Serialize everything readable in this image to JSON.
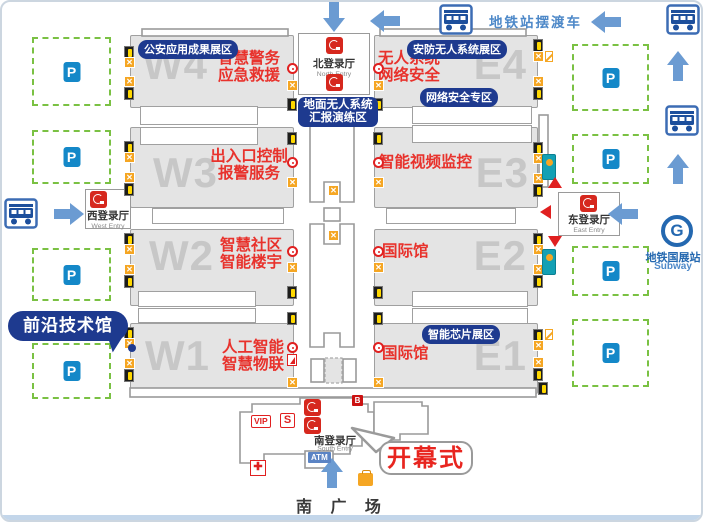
{
  "shuttle": {
    "label": "地铁站摆渡车"
  },
  "subway": {
    "zh": "地铁国展站",
    "en": "Subway",
    "glyph": "G"
  },
  "plaza": {
    "label": "南 广 场"
  },
  "callouts": {
    "frontier": "前沿技术馆",
    "opening": "开幕式"
  },
  "entries": {
    "north": {
      "zh": "北登录厅",
      "en": "North Entry"
    },
    "west": {
      "zh": "西登录厅",
      "en": "West Entry"
    },
    "east": {
      "zh": "东登录厅",
      "en": "East Entry"
    },
    "south": {
      "zh": "南登录厅",
      "en": "South Entry"
    }
  },
  "north_zone_badge": {
    "line1": "地面无人系统",
    "line2": "汇报演练区"
  },
  "halls": {
    "w4": {
      "code": "W4",
      "badge": "公安应用成果展区",
      "line1": "智慧警务",
      "line2": "应急救援"
    },
    "w3": {
      "code": "W3",
      "line1": "出入口控制",
      "line2": "报警服务"
    },
    "w2": {
      "code": "W2",
      "line1": "智慧社区",
      "line2": "智能楼宇"
    },
    "w1": {
      "code": "W1",
      "line1": "人工智能",
      "line2": "智慧物联"
    },
    "e4": {
      "code": "E4",
      "badge": "安防无人系统展区",
      "badge2": "网络安全专区",
      "line1": "无人系统",
      "line2": "网络安全"
    },
    "e3": {
      "code": "E3",
      "line1": "智能视频监控"
    },
    "e2": {
      "code": "E2",
      "line1": "国际馆"
    },
    "e1": {
      "code": "E1",
      "badge": "智能芯片展区",
      "line1": "国际馆"
    }
  },
  "badges": {
    "vip": "VIP",
    "s": "S",
    "b": "B",
    "atm": "ATM",
    "parking": "P",
    "cross": "✚"
  },
  "map": {
    "colors": {
      "arrow": "#6b9bd2",
      "bus": "#1d4f9c",
      "bus_border": "#3c6cb4",
      "red": "#e8322c",
      "navy": "#1e3a8f"
    },
    "parking": [
      {
        "x": 30,
        "y": 35,
        "w": 75,
        "h": 65
      },
      {
        "x": 30,
        "y": 128,
        "w": 75,
        "h": 50
      },
      {
        "x": 30,
        "y": 246,
        "w": 75,
        "h": 49
      },
      {
        "x": 30,
        "y": 341,
        "w": 75,
        "h": 52
      },
      {
        "x": 570,
        "y": 42,
        "w": 73,
        "h": 63
      },
      {
        "x": 570,
        "y": 132,
        "w": 73,
        "h": 46
      },
      {
        "x": 570,
        "y": 244,
        "w": 73,
        "h": 46
      },
      {
        "x": 570,
        "y": 317,
        "w": 73,
        "h": 64
      }
    ],
    "icons": [
      {
        "t": "exit",
        "x": 122,
        "y": 44
      },
      {
        "t": "stairs",
        "x": 122,
        "y": 55
      },
      {
        "t": "stairs",
        "x": 122,
        "y": 74
      },
      {
        "t": "exit",
        "x": 122,
        "y": 85
      },
      {
        "t": "exit",
        "x": 122,
        "y": 139
      },
      {
        "t": "stairs",
        "x": 122,
        "y": 150
      },
      {
        "t": "stairs",
        "x": 122,
        "y": 170
      },
      {
        "t": "exit",
        "x": 122,
        "y": 181
      },
      {
        "t": "exit",
        "x": 122,
        "y": 231
      },
      {
        "t": "stairs",
        "x": 122,
        "y": 242
      },
      {
        "t": "stairs",
        "x": 122,
        "y": 262
      },
      {
        "t": "exit",
        "x": 122,
        "y": 273
      },
      {
        "t": "exit",
        "x": 122,
        "y": 325
      },
      {
        "t": "stairs",
        "x": 122,
        "y": 336
      },
      {
        "t": "stairs",
        "x": 122,
        "y": 356
      },
      {
        "t": "exit",
        "x": 122,
        "y": 367
      },
      {
        "t": "info",
        "x": 285,
        "y": 61
      },
      {
        "t": "stairs",
        "x": 285,
        "y": 78
      },
      {
        "t": "exit",
        "x": 285,
        "y": 96
      },
      {
        "t": "exit",
        "x": 285,
        "y": 130
      },
      {
        "t": "info",
        "x": 285,
        "y": 155
      },
      {
        "t": "stairs",
        "x": 285,
        "y": 175
      },
      {
        "t": "info",
        "x": 285,
        "y": 244
      },
      {
        "t": "stairs",
        "x": 285,
        "y": 260
      },
      {
        "t": "exit",
        "x": 285,
        "y": 284
      },
      {
        "t": "exit",
        "x": 285,
        "y": 310
      },
      {
        "t": "info",
        "x": 285,
        "y": 340
      },
      {
        "t": "redfig",
        "x": 285,
        "y": 352
      },
      {
        "t": "stairs",
        "x": 285,
        "y": 375
      },
      {
        "t": "info",
        "x": 371,
        "y": 61
      },
      {
        "t": "stairs",
        "x": 371,
        "y": 78
      },
      {
        "t": "exit",
        "x": 371,
        "y": 96
      },
      {
        "t": "exit",
        "x": 371,
        "y": 130
      },
      {
        "t": "info",
        "x": 371,
        "y": 155
      },
      {
        "t": "stairs",
        "x": 371,
        "y": 175
      },
      {
        "t": "info",
        "x": 371,
        "y": 244
      },
      {
        "t": "stairs",
        "x": 371,
        "y": 260
      },
      {
        "t": "exit",
        "x": 371,
        "y": 284
      },
      {
        "t": "exit",
        "x": 371,
        "y": 310
      },
      {
        "t": "info",
        "x": 371,
        "y": 340
      },
      {
        "t": "stairs",
        "x": 371,
        "y": 375
      },
      {
        "t": "exit",
        "x": 531,
        "y": 37
      },
      {
        "t": "stairs",
        "x": 531,
        "y": 49
      },
      {
        "t": "slash",
        "x": 543,
        "y": 49
      },
      {
        "t": "stairs",
        "x": 531,
        "y": 74
      },
      {
        "t": "exit",
        "x": 531,
        "y": 85
      },
      {
        "t": "exit",
        "x": 531,
        "y": 140
      },
      {
        "t": "stairs",
        "x": 531,
        "y": 151
      },
      {
        "t": "stairs",
        "x": 531,
        "y": 171
      },
      {
        "t": "exit",
        "x": 531,
        "y": 182
      },
      {
        "t": "exit",
        "x": 531,
        "y": 231
      },
      {
        "t": "stairs",
        "x": 531,
        "y": 242
      },
      {
        "t": "stairs",
        "x": 531,
        "y": 262
      },
      {
        "t": "exit",
        "x": 531,
        "y": 273
      },
      {
        "t": "exit",
        "x": 531,
        "y": 327
      },
      {
        "t": "slash",
        "x": 543,
        "y": 327
      },
      {
        "t": "stairs",
        "x": 531,
        "y": 338
      },
      {
        "t": "stairs",
        "x": 531,
        "y": 355
      },
      {
        "t": "exit",
        "x": 531,
        "y": 366
      },
      {
        "t": "exit",
        "x": 536,
        "y": 380
      },
      {
        "t": "service",
        "x": 540,
        "y": 152
      },
      {
        "t": "service",
        "x": 540,
        "y": 247
      },
      {
        "t": "stairs",
        "x": 326,
        "y": 183
      },
      {
        "t": "stairs",
        "x": 326,
        "y": 228
      }
    ],
    "arrows": [
      {
        "dir": "left",
        "x": 368,
        "y": 8
      },
      {
        "dir": "left",
        "x": 589,
        "y": 9
      },
      {
        "dir": "down",
        "x": 317,
        "y": 4
      },
      {
        "dir": "up",
        "x": 661,
        "y": 53
      },
      {
        "dir": "up",
        "x": 661,
        "y": 156
      },
      {
        "dir": "right",
        "x": 52,
        "y": 201
      },
      {
        "dir": "left",
        "x": 606,
        "y": 201
      },
      {
        "dir": "up",
        "x": 315,
        "y": 460
      }
    ],
    "buses": [
      {
        "x": 437,
        "y": 2
      },
      {
        "x": 664,
        "y": 2
      },
      {
        "x": 663,
        "y": 103
      },
      {
        "x": 2,
        "y": 196
      }
    ],
    "pointers": [
      {
        "dir": "up",
        "x": 546,
        "y": 175
      },
      {
        "dir": "left",
        "x": 538,
        "y": 203
      },
      {
        "dir": "down",
        "x": 546,
        "y": 234
      }
    ]
  }
}
